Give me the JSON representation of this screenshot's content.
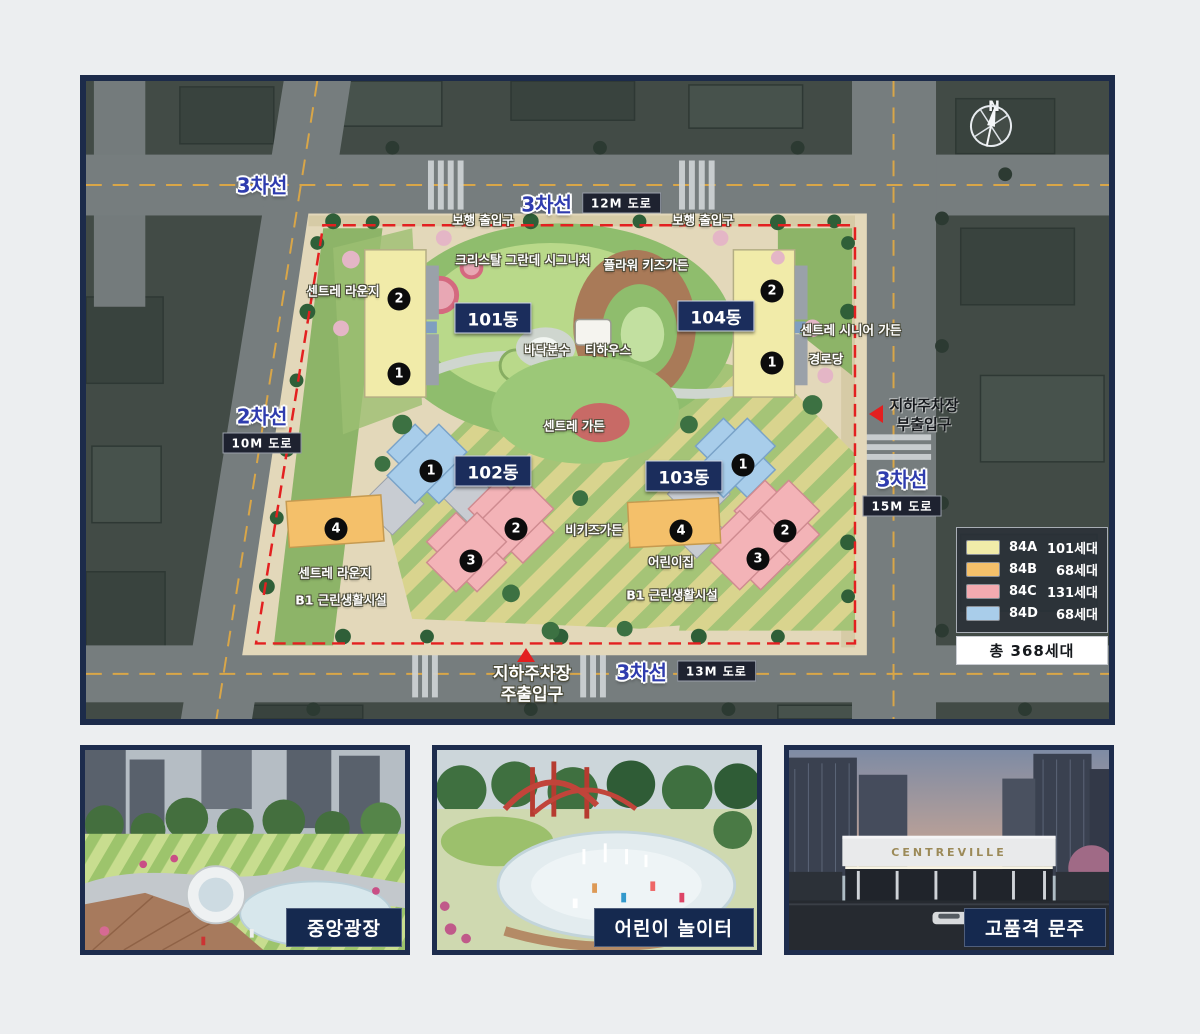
{
  "site_plan": {
    "compass": "N",
    "roads": {
      "outer_top": "3차선",
      "top": {
        "lanes": "3차선",
        "size": "12M 도로"
      },
      "left": {
        "lanes": "2차선",
        "size": "10M 도로"
      },
      "right": {
        "lanes": "3차선",
        "size": "15M 도로"
      },
      "bottom": {
        "lanes": "3차선",
        "size": "13M 도로"
      }
    },
    "entrances": {
      "pedestrian_left": "보행 출입구",
      "pedestrian_right": "보행 출입구",
      "parking_sub": [
        "지하주차장",
        "부출입구"
      ],
      "parking_main": [
        "지하주차장",
        "주출입구"
      ]
    },
    "buildings": [
      {
        "name": "101동",
        "units": [
          "2",
          "1"
        ]
      },
      {
        "name": "102동",
        "units": [
          "1",
          "2",
          "3",
          "4"
        ]
      },
      {
        "name": "103동",
        "units": [
          "1",
          "2",
          "3",
          "4"
        ]
      },
      {
        "name": "104동",
        "units": [
          "2",
          "1"
        ]
      }
    ],
    "facilities": {
      "centre_lounge_top": "센트레 라운지",
      "crystal_grande_signature": "크리스탈 그란데 시그니처",
      "flower_kids_garden": "플라워 키즈가든",
      "centre_senior_garden": "센트레 시니어 가든",
      "senior_center": "경로당",
      "floor_fountain": "바닥분수",
      "tea_house": "티하우스",
      "centre_garden": "센트레 가든",
      "bee_kids_garden": "비키즈가든",
      "daycare": "어린이집",
      "centre_lounge_bottom": "센트레 라운지",
      "b1_neighborhood_left": "B1 근린생활시설",
      "b1_neighborhood_right": "B1 근린생활시설"
    },
    "legend": {
      "items": [
        {
          "type": "84A",
          "count": "101세대",
          "color": "#f1eba9"
        },
        {
          "type": "84B",
          "count": "68세대",
          "color": "#f4c06a"
        },
        {
          "type": "84C",
          "count": "131세대",
          "color": "#f3aab0"
        },
        {
          "type": "84D",
          "count": "68세대",
          "color": "#a9cdea"
        }
      ],
      "total": "총 368세대"
    }
  },
  "photos": [
    {
      "caption": "중앙광장"
    },
    {
      "caption": "어린이 놀이터"
    },
    {
      "caption": "고품격 문주",
      "gate_sign": "CENTREVILLE"
    }
  ]
}
